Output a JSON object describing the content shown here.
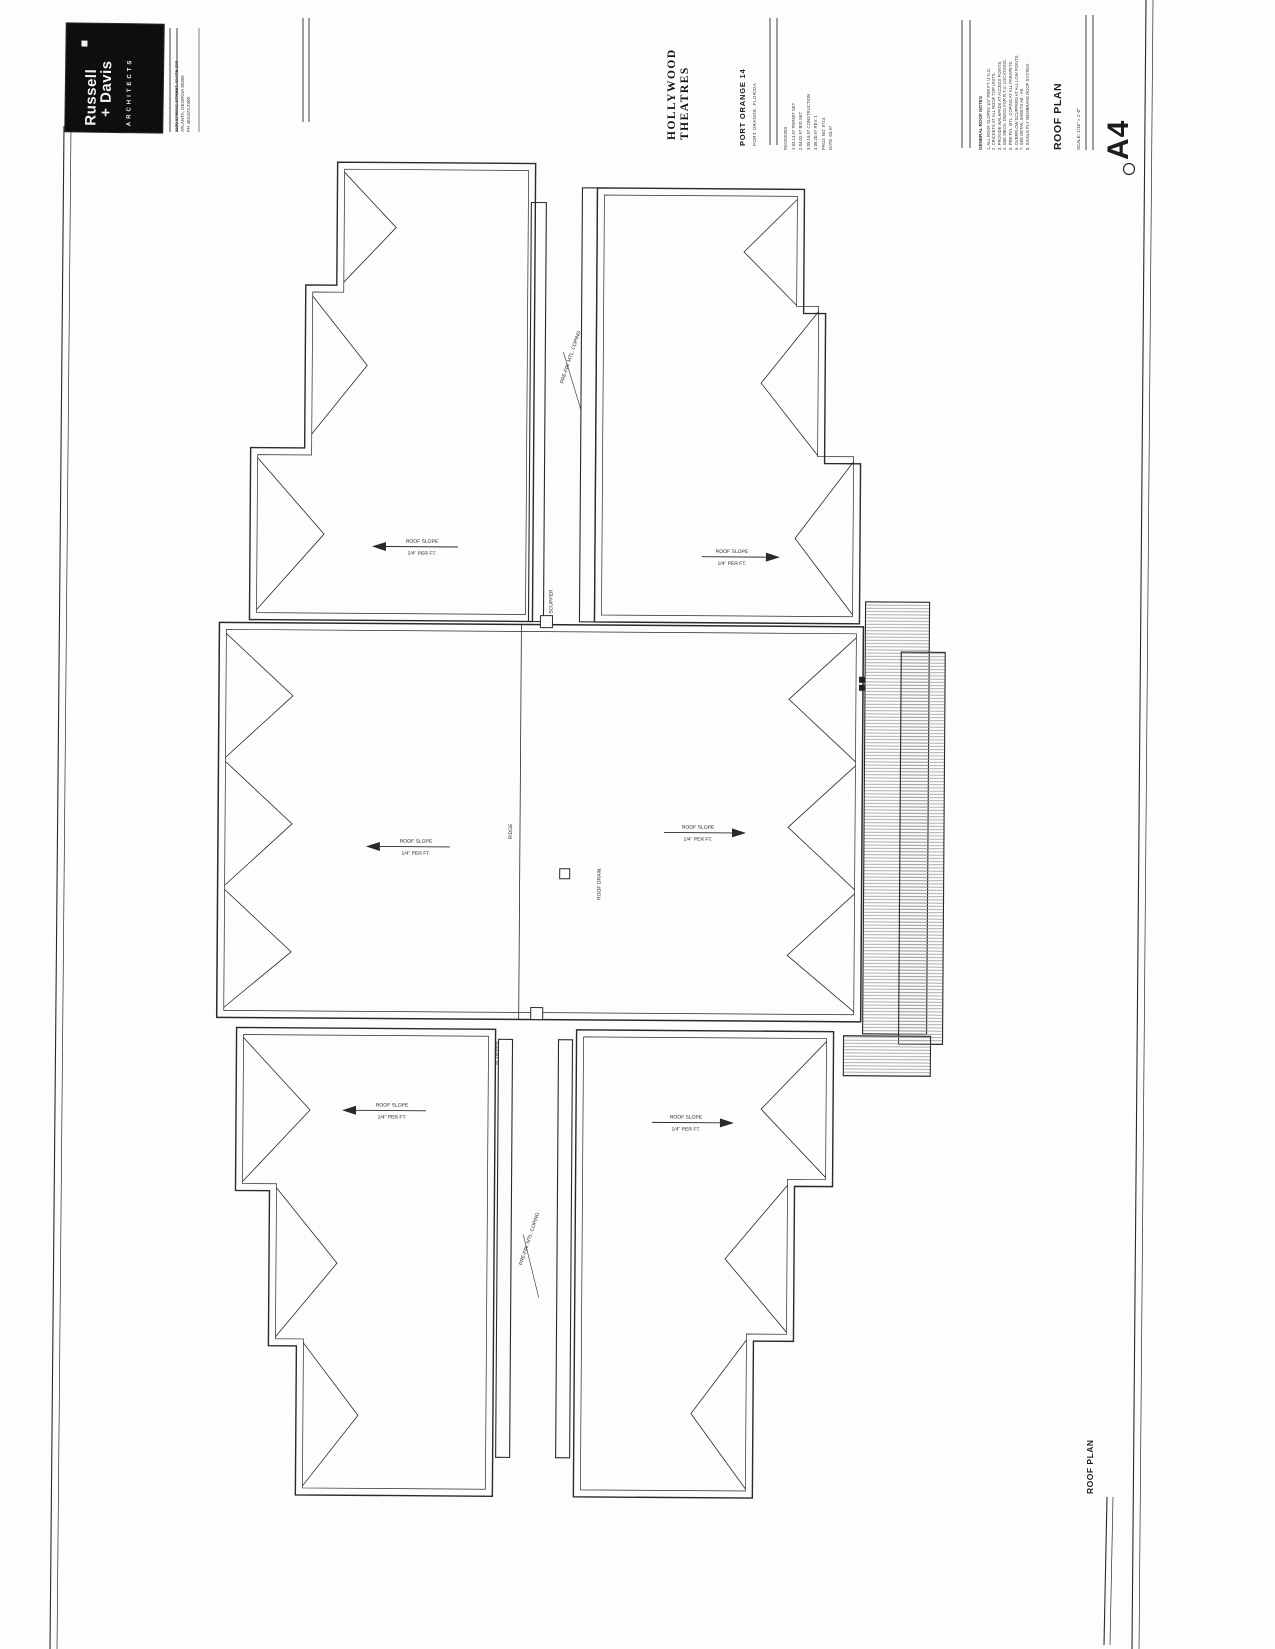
{
  "title_block": {
    "logo": {
      "name_line1": "Russell",
      "name_line2": "+ Davis",
      "tagline": "ARCHITECTS"
    },
    "address_lines": [
      "1100 SPRING STREET, SUITE 200",
      "ATLANTA, GEORGIA 30309",
      "PH 404.873.2300"
    ],
    "client_line1": "HOLLYWOOD",
    "client_line2": "THEATRES",
    "project_name": "PORT ORANGE 14",
    "project_sub": "PORT ORANGE, FLORIDA",
    "revision_rows": [
      "REVISIONS",
      "1   03.14.97   PERMIT SET",
      "2   04.02.97   BID SET",
      "3   05.16.97   CONSTRUCTION",
      "4   06.20.97   REV. 1",
      "PROJ. NO:  9714",
      "DATE:  03.97"
    ],
    "notes_title": "GENERAL ROOF NOTES",
    "notes_lines": [
      "1. ALL ROOF SLOPES 1/4\" PER FT. U.N.O.",
      "2. CRICKETS AT ALL ROOF TOP UNITS.",
      "3. PROVIDE WALKPADS AT ACCESS POINTS.",
      "4. SEE MECH. DWGS FOR R.T.U. LOCATIONS.",
      "5. PRE-FIN. MTL. COPING AT ALL PARAPETS.",
      "6. OVERFLOW SCUPPERS AT ALL LOW POINTS.",
      "7. SEE DETAIL SHEETS A8 - A9.",
      "8. SINGLE PLY MEMBRANE ROOF SYSTEM."
    ],
    "sheet_title": "ROOF PLAN",
    "sheet_scale": "SCALE: 1/16\" = 1'-0\"",
    "sheet_number": "A4"
  },
  "plan": {
    "slope_label_top": "ROOF SLOPE",
    "slope_label_bottom": "1/4\" PER FT.",
    "coping_label": "PRE-FIN. MTL. COPING",
    "ridge_label": "RIDGE",
    "scupper_label": "SCUPPER",
    "drain_label": "ROOF DRAIN",
    "footer_title": "ROOF PLAN"
  },
  "colors": {
    "ink": "#2a2a2a",
    "hatch": "#9a9a9a",
    "logo_bg": "#0e0e0e"
  }
}
